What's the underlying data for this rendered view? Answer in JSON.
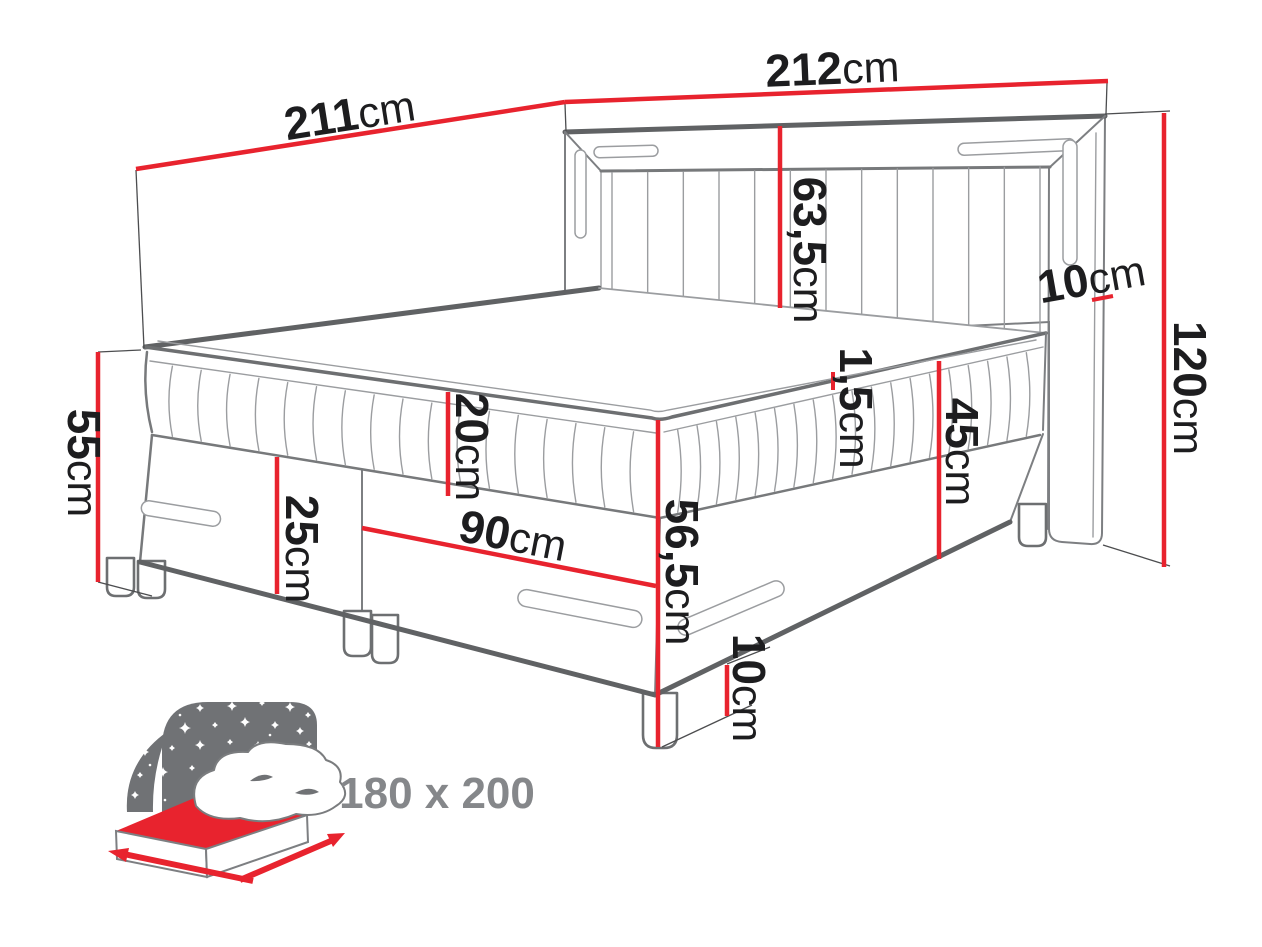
{
  "diagram": {
    "type": "furniture-dimension-diagram",
    "subject": "boxspring-bed",
    "accent_color": "#e8232e",
    "outline_color": "#6a6c6e",
    "text_color": "#1d1d1f",
    "dimensions": {
      "total_length": {
        "value": "211",
        "unit": "cm"
      },
      "total_width": {
        "value": "212",
        "unit": "cm"
      },
      "headboard_panel_height": {
        "value": "63,5",
        "unit": "cm"
      },
      "headboard_side_depth": {
        "value": "10",
        "unit": "cm"
      },
      "headboard_total_height": {
        "value": "120",
        "unit": "cm"
      },
      "head_end_mattress_height": {
        "value": "55",
        "unit": "cm"
      },
      "mattress_height": {
        "value": "20",
        "unit": "cm"
      },
      "base_height": {
        "value": "25",
        "unit": "cm"
      },
      "single_box_width": {
        "value": "90",
        "unit": "cm"
      },
      "topper_height": {
        "value": "1,5",
        "unit": "cm"
      },
      "mattress_plus_base_height": {
        "value": "45",
        "unit": "cm"
      },
      "floor_to_mattress_top": {
        "value": "56,5",
        "unit": "cm"
      },
      "leg_height": {
        "value": "10",
        "unit": "cm"
      }
    },
    "badge": {
      "size_label": "180 x 200"
    }
  }
}
